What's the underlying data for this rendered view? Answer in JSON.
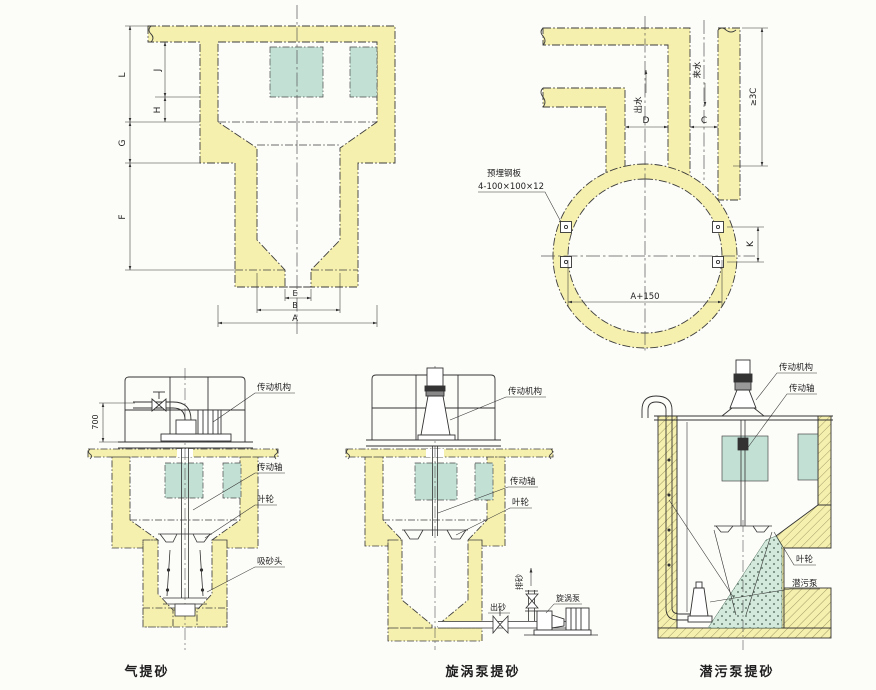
{
  "colors": {
    "concrete": "#f6f0ae",
    "opening": "#c3e0d5",
    "sand": "#d2e9dc",
    "line": "#333333",
    "background": "#fcfcf9"
  },
  "section": {
    "dims": {
      "L": "L",
      "J": "J",
      "H": "H",
      "G": "G",
      "F": "F",
      "E": "E",
      "B": "B",
      "A": "A"
    }
  },
  "plan": {
    "dims": {
      "D": "D",
      "C": "C",
      "K": "K",
      "a150": "A+150",
      "clearance": "≥3C"
    },
    "flow_out": "出水",
    "flow_in": "来水",
    "note1": "预埋钢板",
    "note2": "4-100×100×12"
  },
  "airlift": {
    "caption": "气提砂",
    "dim700": "700",
    "drive": "传动机构",
    "shaft": "传动轴",
    "impeller": "叶轮",
    "suction": "吸砂头"
  },
  "vortex": {
    "caption": "旋涡泵提砂",
    "drive": "传动机构",
    "shaft": "传动轴",
    "impeller": "叶轮",
    "riser": "排砂",
    "outlet": "出砂",
    "pump": "旋涡泵"
  },
  "sub": {
    "caption": "潜污泵提砂",
    "drive": "传动机构",
    "shaft": "传动轴",
    "impeller": "叶轮",
    "pump": "潜污泵"
  }
}
